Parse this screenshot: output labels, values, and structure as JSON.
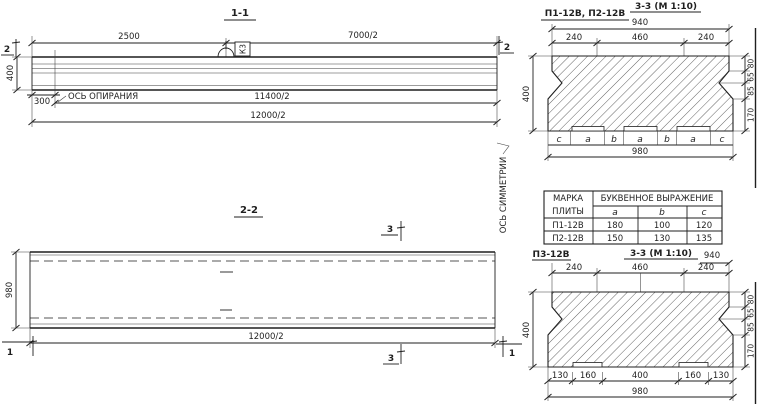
{
  "colors": {
    "ink": "#1f1f1f",
    "paper": "#ffffff"
  },
  "s1": {
    "title": "1-1",
    "cut_label_left": "2",
    "cut_label_right": "2",
    "dim_2500": "2500",
    "dim_7000": "7000/2",
    "dim_11400": "11400/2",
    "dim_12000": "12000/2",
    "dim_400": "400",
    "dim_300": "300",
    "support_axis_label": "ОСЬ ОПИРАНИЯ",
    "loop_label": "К3"
  },
  "s2": {
    "title": "2-2",
    "dim_980": "980",
    "dim_12000": "12000/2",
    "cut_label_3a": "3",
    "cut_label_3b": "3",
    "cut_label_1a": "1",
    "cut_label_1b": "1",
    "symmetry_axis_label": "ОСЬ СИММЕТРИИ"
  },
  "s3a": {
    "plate_label": "П1-12В, П2-12В",
    "title": "3-3 (М 1:10)",
    "dim_940": "940",
    "dims_top": [
      "240",
      "460",
      "240"
    ],
    "letters": [
      "c",
      "a",
      "b",
      "a",
      "b",
      "a",
      "c"
    ],
    "dim_980": "980",
    "dim_400": "400",
    "dims_right": [
      "80",
      "65",
      "85",
      "170"
    ]
  },
  "table": {
    "header_col1_line1": "МАРКА",
    "header_col1_line2": "ПЛИТЫ",
    "header_expr": "БУКВЕННОЕ ВЫРАЖЕНИЕ",
    "col_a": "a",
    "col_b": "b",
    "col_c": "c",
    "rows": [
      {
        "mark": "П1-12В",
        "a": "180",
        "b": "100",
        "c": "120"
      },
      {
        "mark": "П2-12В",
        "a": "150",
        "b": "130",
        "c": "135"
      }
    ]
  },
  "s3b": {
    "plate_label": "П3-12В",
    "title": "3-3 (М 1:10)",
    "dim_940": "940",
    "dims_top": [
      "240",
      "460",
      "240"
    ],
    "dims_bottom": [
      "130",
      "160",
      "400",
      "160",
      "130"
    ],
    "dim_980": "980",
    "dim_400": "400",
    "dims_right": [
      "80",
      "65",
      "85",
      "170"
    ]
  }
}
